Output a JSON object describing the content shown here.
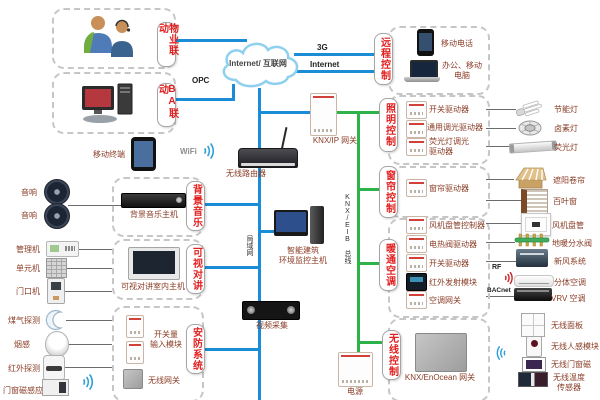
{
  "colors": {
    "line_blue": "#1b8dd6",
    "line_green": "#2eb34a",
    "label_red": "#e11f1f",
    "item_text": "#8a3c25"
  },
  "cloud": {
    "label": "Internet/ 互联网"
  },
  "annotations": {
    "g3": "3G",
    "internet": "Internet",
    "opc": "OPC",
    "wifi": "WiFi",
    "lan": "局域网",
    "knx_bus": "KNX/EIB 总线",
    "rf": "RF",
    "bacnet": "BACnet"
  },
  "left": {
    "property_box": {
      "label": "物业联动"
    },
    "ba_box": {
      "label": "BA联动"
    },
    "mobile_terminal": {
      "label": "移动终端"
    },
    "music_box": {
      "label": "背景音乐",
      "host": "背景音乐主机",
      "speakers": [
        "音响",
        "音响"
      ]
    },
    "intercom_box": {
      "label": "可视对讲",
      "host": "可视对讲室内主机",
      "devices": [
        "管理机",
        "单元机",
        "门口机"
      ]
    },
    "security_box": {
      "label": "安防系统",
      "input_module": "开关量\n输入模块",
      "gateway": "无线网关",
      "sensors": [
        "煤气探测",
        "烟感",
        "红外探测",
        "门窗磁感应"
      ]
    }
  },
  "center": {
    "router": "无线路由器",
    "knx_ip_gateway": "KNX/IP 网关",
    "monitor_host": "智能建筑\n环境监控主机",
    "video_capture": "视频采集",
    "power": "电源"
  },
  "right": {
    "remote_box": {
      "label": "远程控制",
      "phone": "移动电话",
      "computer": "办公、移动\n电脑"
    },
    "lighting_box": {
      "label": "照明控制",
      "drivers": [
        "开关驱动器",
        "通用调光驱动器",
        "荧光灯调光\n驱动器"
      ],
      "loads": [
        "节能灯",
        "卤素灯",
        "荧光灯"
      ]
    },
    "curtain_box": {
      "label": "窗帘控制",
      "drivers": [
        "窗帘驱动器"
      ],
      "loads": [
        "遮阳卷帘",
        "百叶窗"
      ]
    },
    "hvac_box": {
      "label": "暖通空调",
      "drivers": [
        "风机盘管控制器",
        "电热阀驱动器",
        "开关驱动器",
        "红外发射模块",
        "空调网关"
      ],
      "loads": [
        "风机盘管",
        "地暖分水阀",
        "新风系统",
        "分体空调",
        "VRV 空调"
      ]
    },
    "wireless_box": {
      "label": "无线控制",
      "gateway": "KNX/EnOcean 网关",
      "devices": [
        "无线面板",
        "无线人感模块",
        "无线门窗磁",
        "无线温度\n传感器"
      ]
    }
  }
}
